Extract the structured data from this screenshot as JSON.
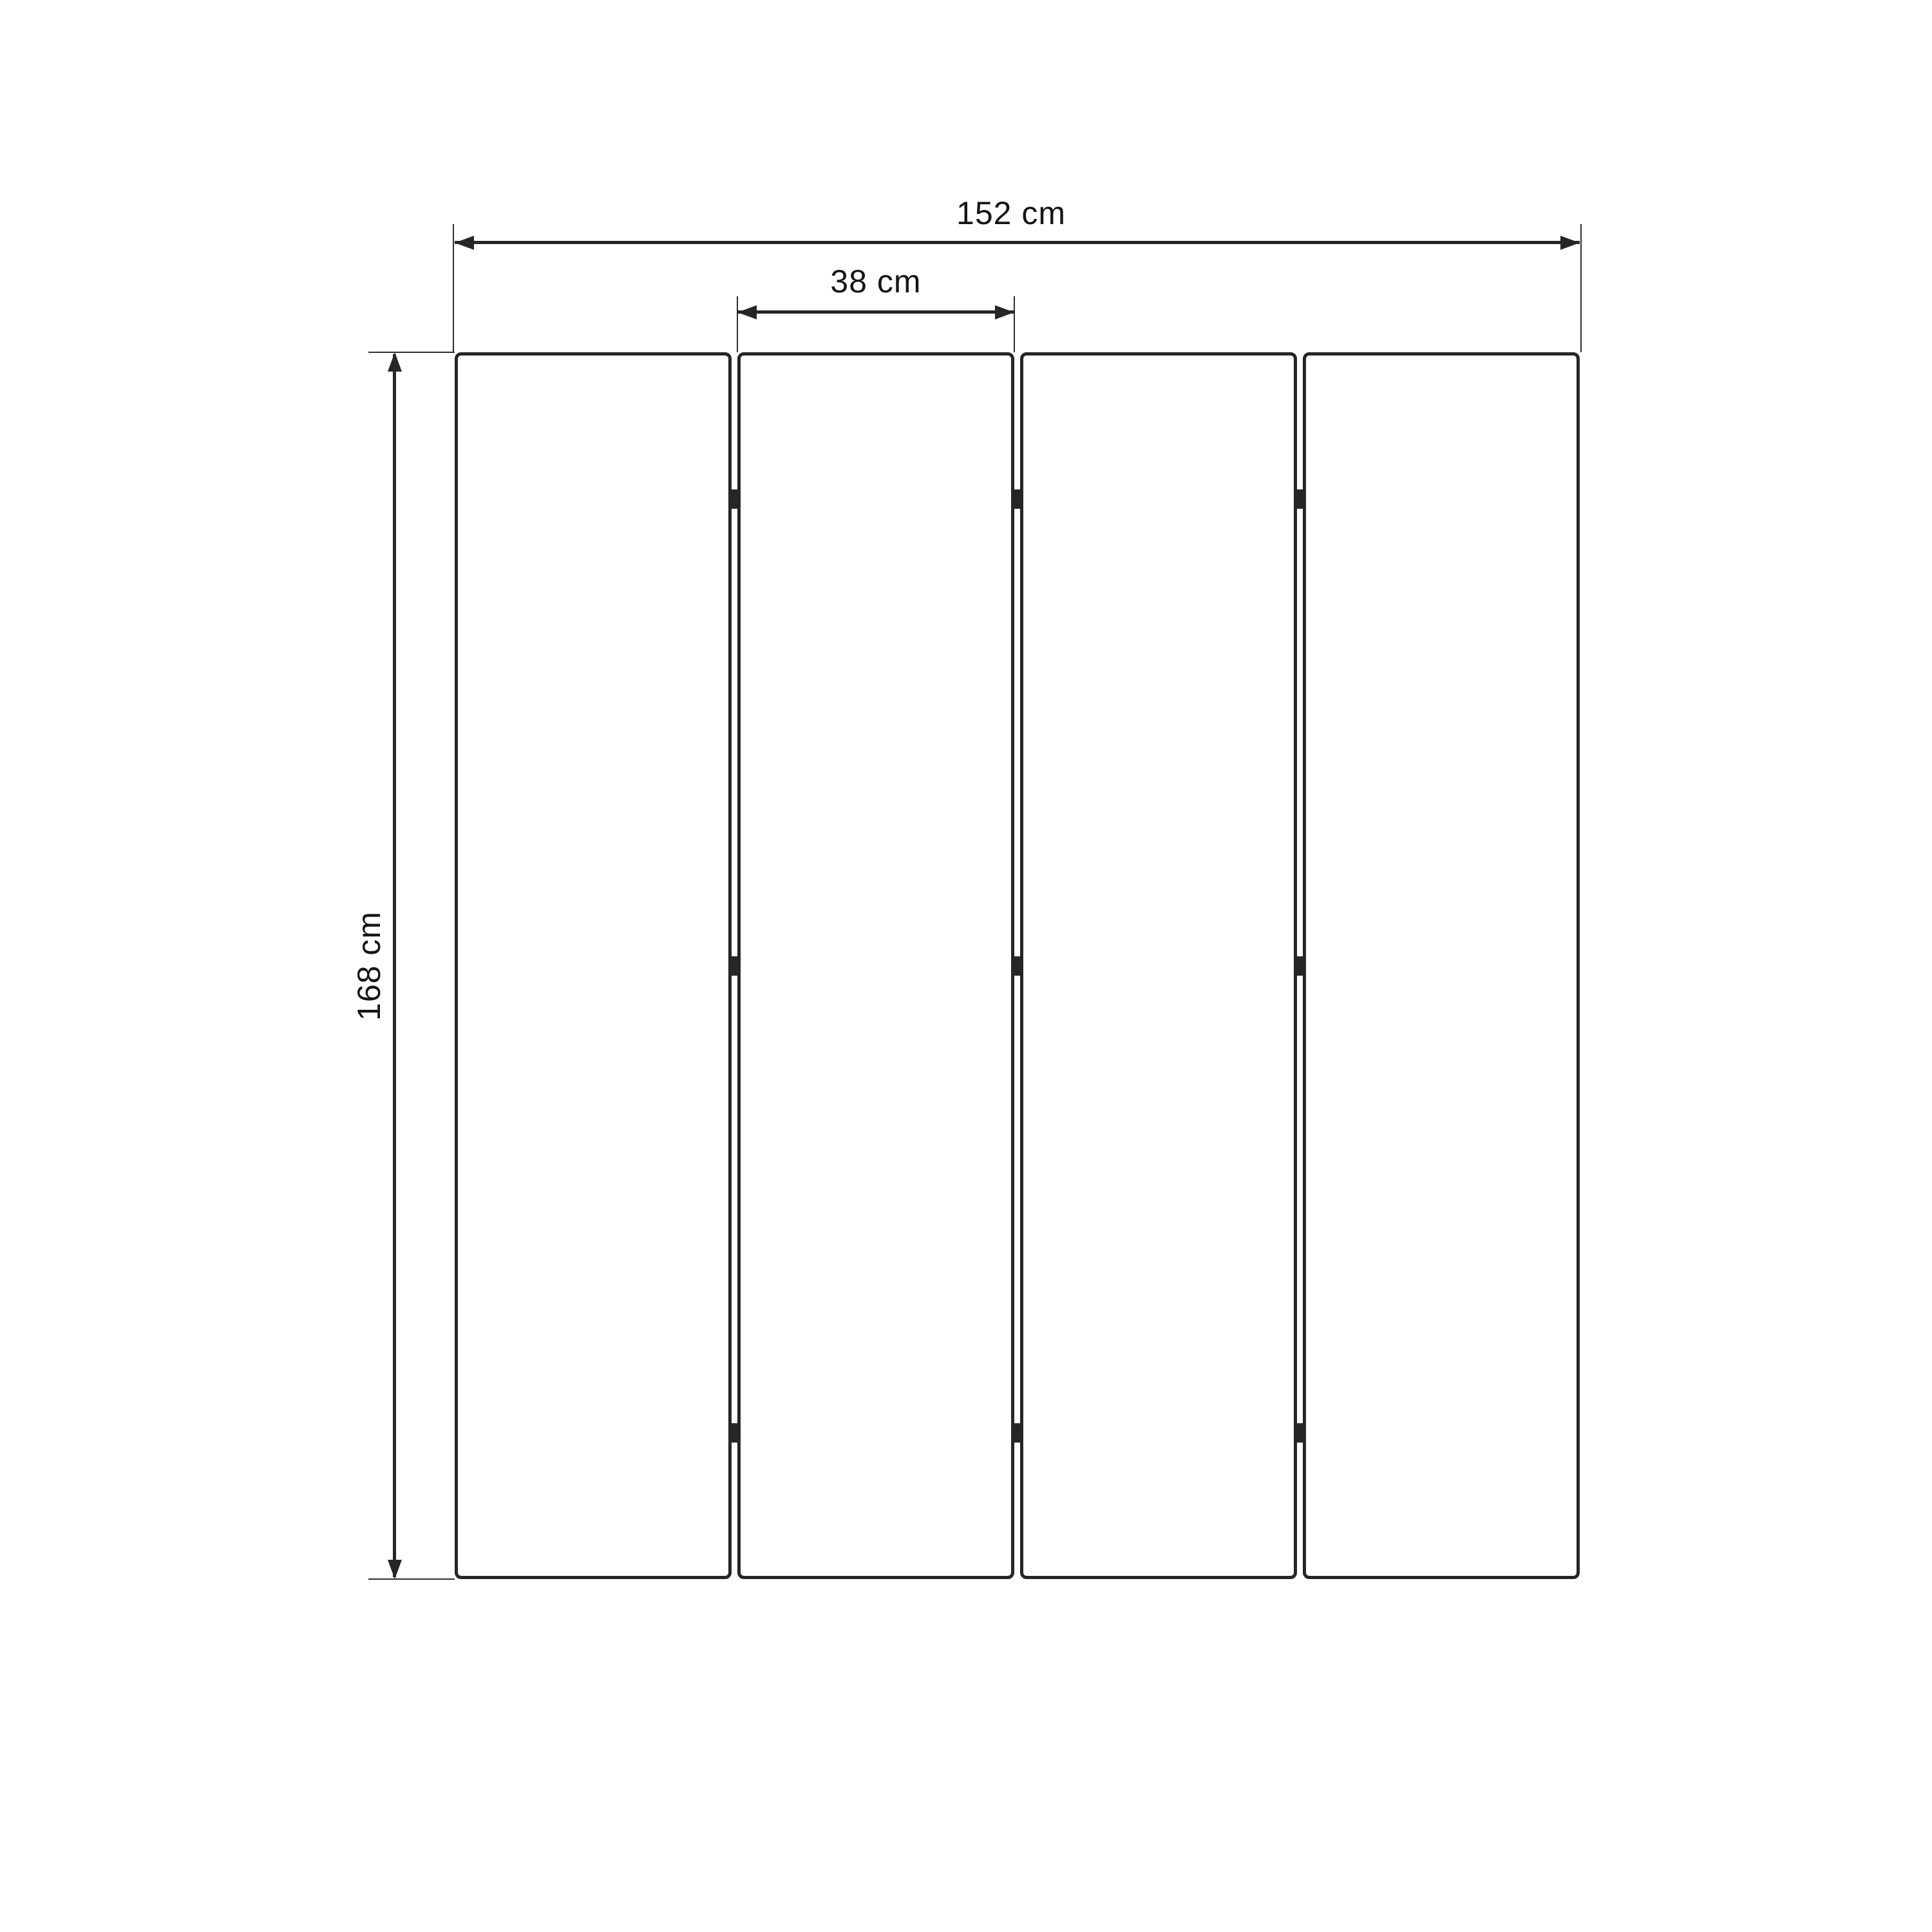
{
  "diagram": {
    "type": "technical-dimension-drawing",
    "subject": "four-panel folding screen, front elevation",
    "background_color": "#ffffff",
    "line_color": "#262626",
    "text_color": "#161616",
    "panels": {
      "count": 4,
      "hinge_rows": 3,
      "hinge_marks_total": 9
    },
    "dimensions": {
      "total_width": {
        "value": 152,
        "unit": "cm",
        "label": "152 cm"
      },
      "panel_width": {
        "value": 38,
        "unit": "cm",
        "label": "38 cm"
      },
      "height": {
        "value": 168,
        "unit": "cm",
        "label": "168 cm"
      }
    }
  }
}
